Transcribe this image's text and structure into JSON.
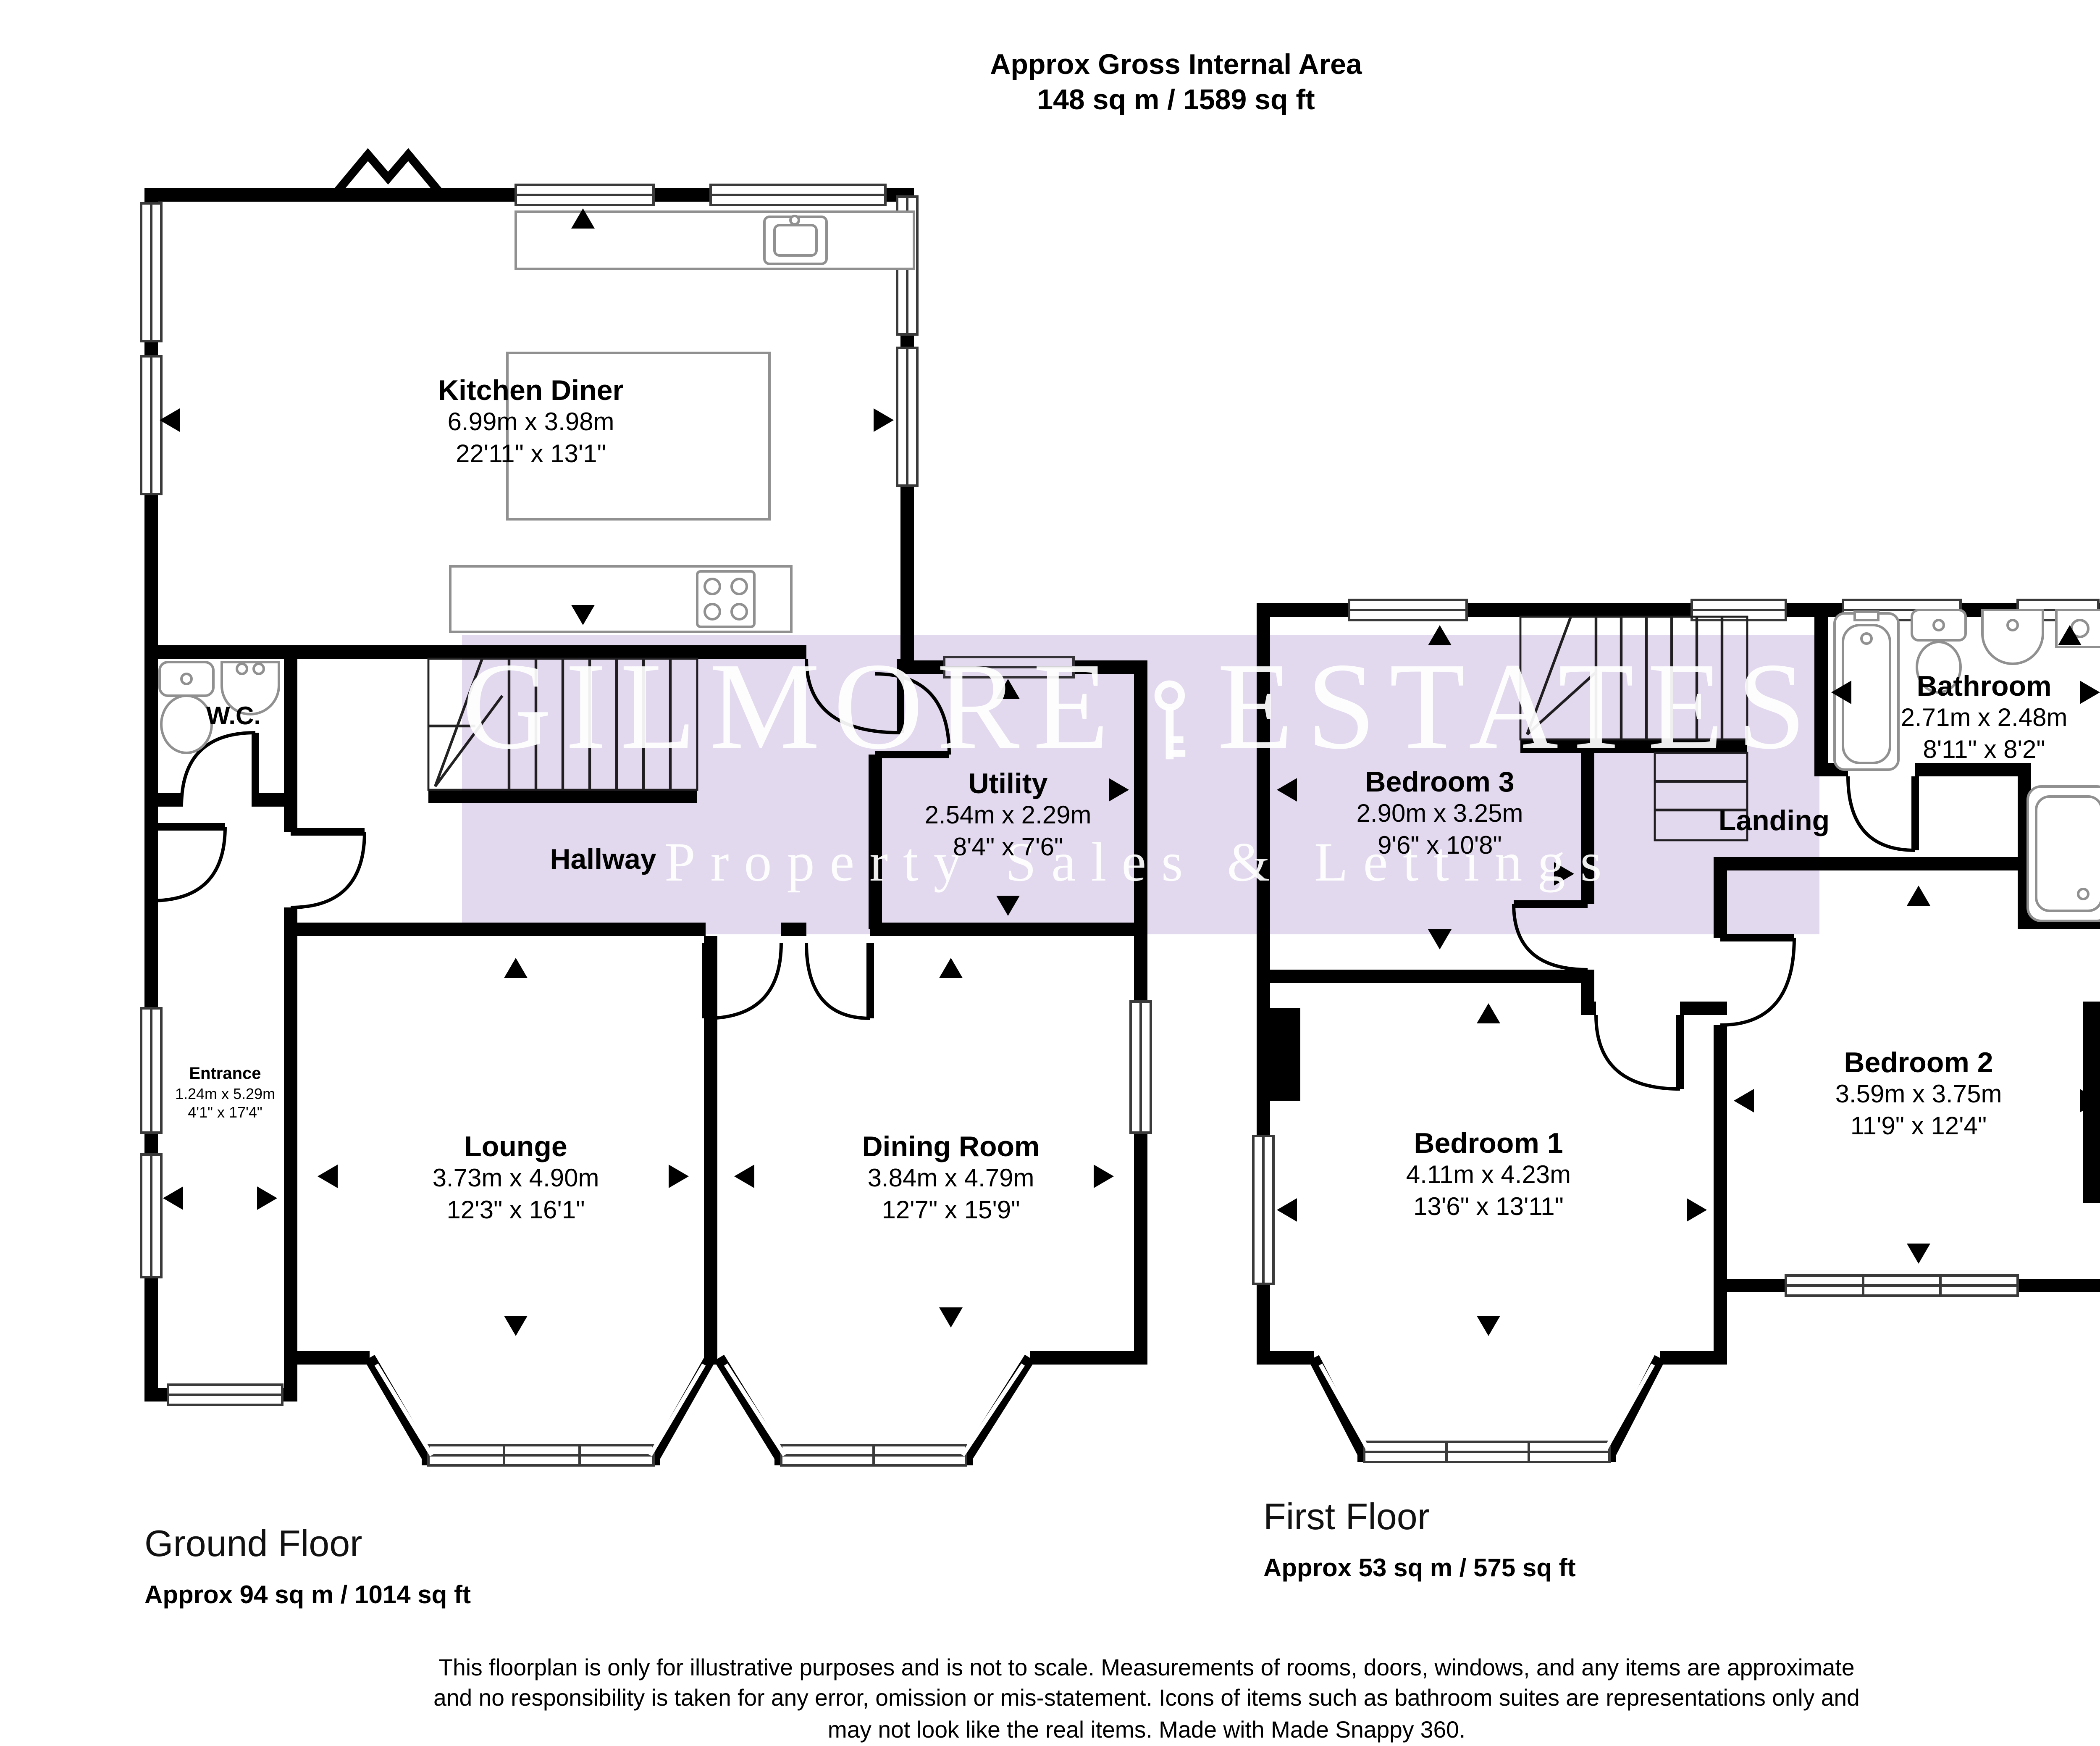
{
  "header": {
    "line1": "Approx Gross Internal Area",
    "line2": "148 sq m / 1589 sq ft"
  },
  "watermark": {
    "brand_left": "GILMORE",
    "brand_right": "ESTATES",
    "tagline": "Property Sales & Lettings",
    "band_color": "#e3d9ee"
  },
  "ground_floor": {
    "label": "Ground Floor",
    "area": "Approx 94 sq m / 1014 sq ft",
    "rooms": {
      "kitchen": {
        "name": "Kitchen Diner",
        "metric": "6.99m x 3.98m",
        "imperial": "22'11\" x 13'1\""
      },
      "wc": {
        "name": "W.C."
      },
      "hallway": {
        "name": "Hallway"
      },
      "utility": {
        "name": "Utility",
        "metric": "2.54m x 2.29m",
        "imperial": "8'4\" x 7'6\""
      },
      "entrance": {
        "name": "Entrance",
        "metric": "1.24m x 5.29m",
        "imperial": "4'1\" x 17'4\""
      },
      "lounge": {
        "name": "Lounge",
        "metric": "3.73m x 4.90m",
        "imperial": "12'3\" x 16'1\""
      },
      "dining": {
        "name": "Dining Room",
        "metric": "3.84m x 4.79m",
        "imperial": "12'7\" x 15'9\""
      }
    }
  },
  "first_floor": {
    "label": "First Floor",
    "area": "Approx 53 sq m / 575 sq ft",
    "rooms": {
      "bedroom1": {
        "name": "Bedroom 1",
        "metric": "4.11m x 4.23m",
        "imperial": "13'6\" x 13'11\""
      },
      "bedroom2": {
        "name": "Bedroom 2",
        "metric": "3.59m x 3.75m",
        "imperial": "11'9\" x 12'4\""
      },
      "bedroom3": {
        "name": "Bedroom 3",
        "metric": "2.90m x 3.25m",
        "imperial": "9'6\" x 10'8\""
      },
      "bathroom": {
        "name": "Bathroom",
        "metric": "2.71m x 2.48m",
        "imperial": "8'11\" x 8'2\""
      },
      "landing": {
        "name": "Landing"
      }
    }
  },
  "footer": {
    "line1": "This floorplan is only for illustrative purposes and is not to scale. Measurements of rooms, doors, windows, and any items are approximate",
    "line2": "and no responsibility is taken for any error, omission or mis-statement. Icons of items such as bathroom suites are representations only and",
    "line3": "may not look like the real items. Made with Made Snappy 360."
  },
  "colors": {
    "wall": "#000000",
    "fixture_outline": "#909090",
    "watermark_band": "#e3d9ee"
  }
}
